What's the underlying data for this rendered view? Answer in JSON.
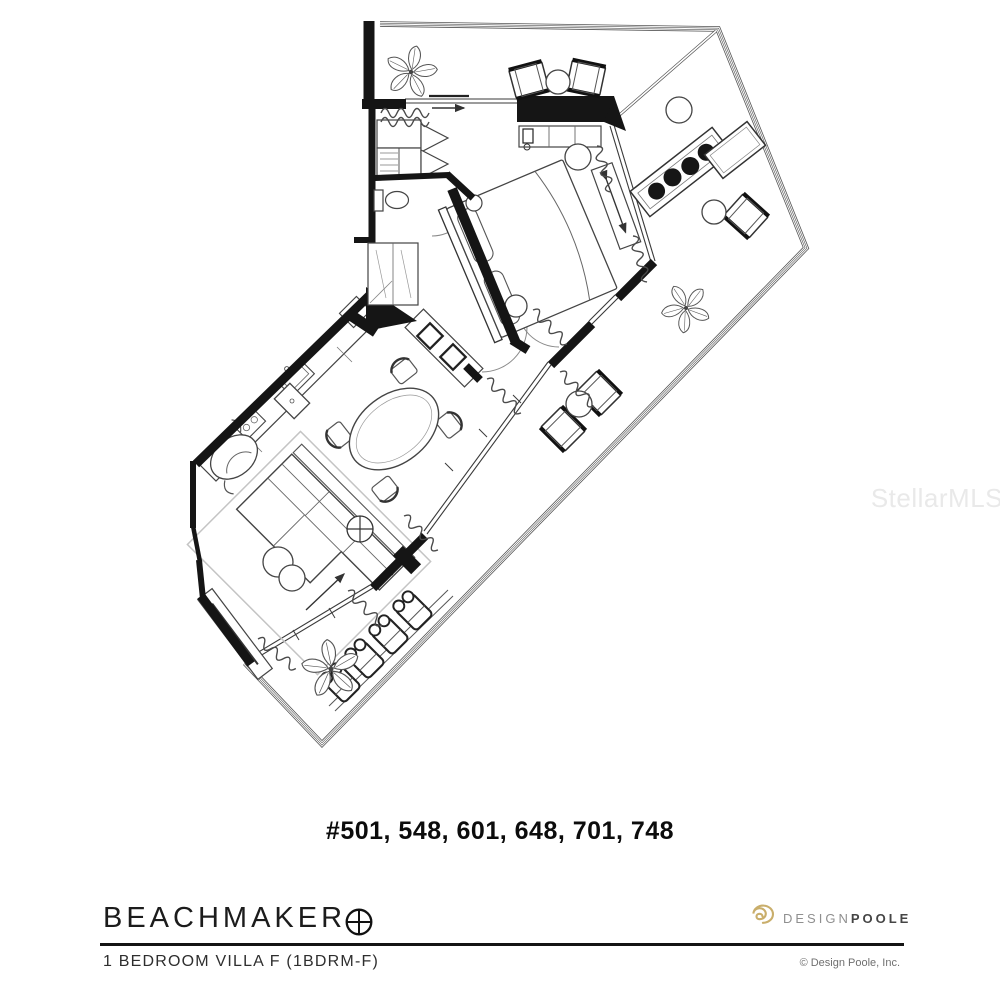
{
  "watermark": "StellarMLS",
  "plan": {
    "unit_numbers": "#501, 548, 601, 648, 701, 748"
  },
  "footer": {
    "brand": "BEACHMAKER",
    "plan_name": "1 BEDROOM VILLA F (1BDRM-F)",
    "logo_design": "DESIGN",
    "logo_poole": "POOLE",
    "copyright": "© Design Poole, Inc."
  },
  "colors": {
    "wall_black": "#151515",
    "line_gray": "#3a3a3a",
    "logo_spiral_gold": "#c9ae6b",
    "logo_design_gray": "#8f8f8f",
    "logo_poole_dark": "#454545",
    "watermark_gray": "#e9e9e9"
  },
  "icons": {
    "compass": "compass-icon",
    "spiral": "spiral-icon",
    "plant": "plant-icon"
  }
}
